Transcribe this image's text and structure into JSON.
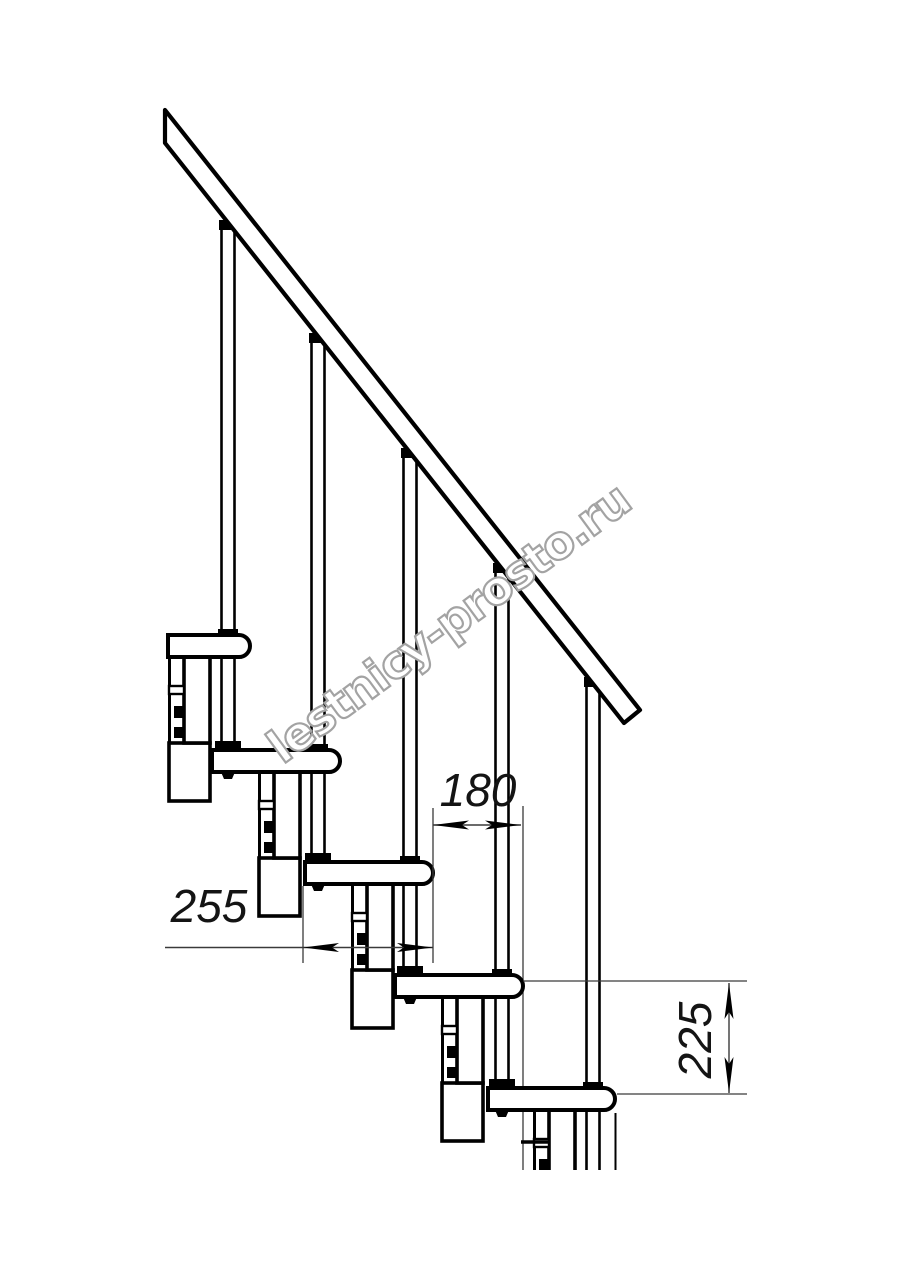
{
  "watermark": {
    "text": "lestnicy-prosto.ru",
    "color": "#a3a3a3"
  },
  "dimensions": {
    "tread_depth": "255",
    "run": "180",
    "rise": "225"
  },
  "colors": {
    "ink": "#000000",
    "thin_line": "#3a3a3a",
    "paper": "#ffffff",
    "dim_text": "#141414"
  },
  "geometry": {
    "canvas": {
      "w": 914,
      "h": 1280
    },
    "cut_y": 1170,
    "rail": {
      "points": "165,110 640,710 624,723 165,143",
      "stroke_w": 4.2
    },
    "tread_h": 22,
    "tread_radius": 11,
    "treads": [
      {
        "x": 168,
        "y": 635,
        "w": 82
      },
      {
        "x": 212,
        "y": 750,
        "w": 128
      },
      {
        "x": 305,
        "y": 862,
        "w": 128
      },
      {
        "x": 395,
        "y": 975,
        "w": 128
      },
      {
        "x": 488,
        "y": 1088,
        "w": 127
      }
    ],
    "support": {
      "col_dx1": -66,
      "col_dx2": -40,
      "col_h": 86,
      "box_dx1": -81,
      "box_h": 58,
      "tab": [
        -81,
        29,
        15,
        8
      ],
      "bolts": [
        [
          -76,
          49,
          10,
          12
        ],
        [
          -76,
          70,
          10,
          11
        ]
      ]
    },
    "baluster_w": 13,
    "balusters": [
      {
        "cx": 228,
        "top": 228,
        "bottom": 750,
        "seat_tread": 1
      },
      {
        "cx": 318,
        "top": 341,
        "bottom": 862,
        "seat_tread": 2
      },
      {
        "cx": 410,
        "top": 456,
        "bottom": 975,
        "seat_tread": 3
      },
      {
        "cx": 502,
        "top": 571,
        "bottom": 1088,
        "seat_tread": 4
      },
      {
        "cx": 593,
        "top": 685,
        "bottom": 1170,
        "seat_tread": -1
      }
    ],
    "behind_lines": [
      [
        523,
        806,
        523,
        1170
      ]
    ],
    "extra_lines": [
      [
        615.5,
        1113,
        615.5,
        1170,
        2
      ],
      [
        521,
        1142,
        549,
        1142,
        3.5
      ]
    ],
    "dims": [
      {
        "name": "dimension-tread-depth",
        "ext": [
          [
            303,
            886,
            303,
            963
          ],
          [
            433,
            808,
            433,
            963
          ]
        ],
        "line": [
          165,
          947.5,
          433,
          947.5
        ],
        "arrows": [
          [
            303,
            947.5,
            180
          ],
          [
            433,
            947.5,
            0
          ]
        ]
      },
      {
        "name": "dimension-run",
        "ext": [],
        "line": [
          433,
          825,
          521,
          825
        ],
        "arrows": [
          [
            433,
            825,
            180
          ],
          [
            521,
            825,
            0
          ]
        ]
      },
      {
        "name": "dimension-rise",
        "ext": [
          [
            523,
            981,
            747,
            981
          ],
          [
            617,
            1094,
            747,
            1094
          ]
        ],
        "line": [
          729,
          983,
          729,
          1093
        ],
        "arrows": [
          [
            729,
            983,
            -90
          ],
          [
            729,
            1093,
            90
          ]
        ]
      }
    ]
  }
}
